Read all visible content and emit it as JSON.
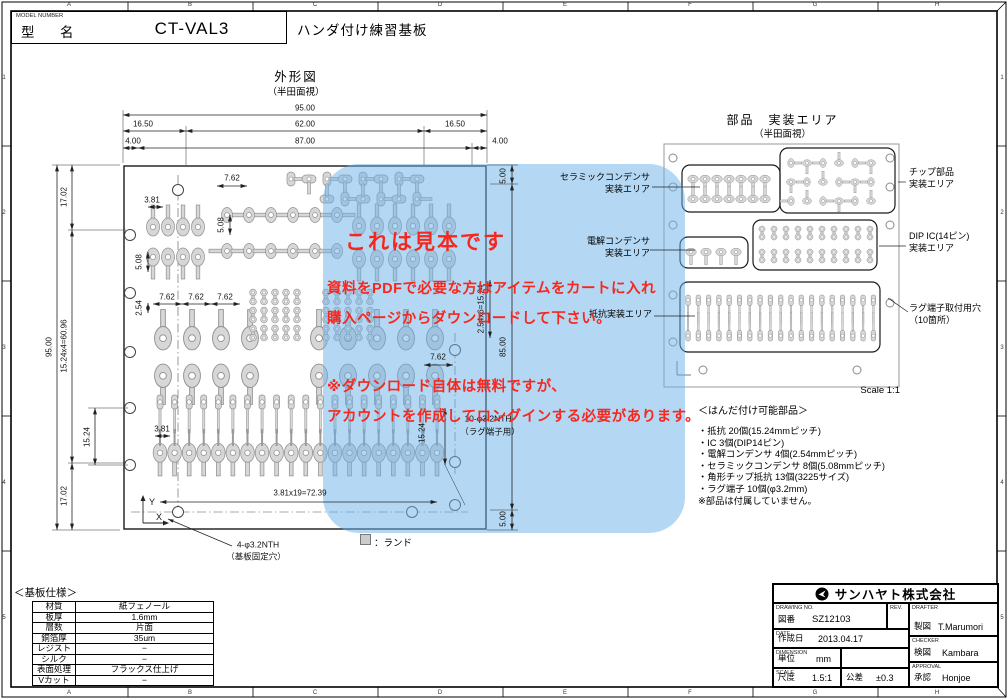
{
  "frame": {
    "cols": [
      "A",
      "B",
      "C",
      "D",
      "E",
      "F",
      "G",
      "H"
    ],
    "rows": [
      "1",
      "2",
      "3",
      "4",
      "5"
    ]
  },
  "title_top": {
    "model_number_label": "MODEL NUMBER",
    "model_label": "型　名",
    "model_value": "CT-VAL3",
    "product_name": "ハンダ付け練習基板"
  },
  "outline": {
    "title": "外形図",
    "subtitle": "（半田面視）"
  },
  "mount_view": {
    "title": "部品　実装エリア",
    "subtitle": "（半田面視）",
    "chip_1": "チップ部品",
    "chip_2": "実装エリア",
    "dip_1": "DIP IC(14ピン)",
    "dip_2": "実装エリア",
    "lug_1": "ラグ端子取付用穴",
    "lug_2": "（10箇所）",
    "scale_note": "Scale 1:1"
  },
  "area_labels": {
    "ceramic_1": "セラミックコンデンサ",
    "ceramic_2": "実装エリア",
    "elec_1": "電解コンデンサ",
    "elec_2": "実装エリア",
    "res": "抵抗実装エリア"
  },
  "dims": {
    "w95": "95.00",
    "w165a": "16.50",
    "w62": "62.00",
    "w165b": "16.50",
    "w4a": "4.00",
    "w87": "87.00",
    "w4b": "4.00",
    "h95": "95.00",
    "h1702a": "17.02",
    "h1524x4": "15.24x4=60.96",
    "h1702b": "17.02",
    "h1524": "15.24",
    "p762a": "7.62",
    "p381a": "3.81",
    "p508a": "5.08",
    "p508b": "5.08",
    "p254": "2.54",
    "p762b": "7.62",
    "p762c": "7.62",
    "p762d": "7.62",
    "p381b": "3.81",
    "p762e": "7.62",
    "row381": "3.81x19=72.39",
    "v254x6": "2.54x6=15.24",
    "v85": "85.00",
    "v1524": "15.24",
    "v5a": "5.00",
    "v5b": "5.00"
  },
  "notes": {
    "hole1a": "4-φ3.2NTH",
    "hole1b": "（基板固定穴）",
    "hole2a": "10-φ3.2NTH",
    "hole2b": "（ラグ端子用）",
    "land": "：ランド",
    "axis_x": "X",
    "axis_y": "Y"
  },
  "watermark": {
    "headline": "これは見本です",
    "lines": [
      "資料をPDFで必要な方はアイテムをカートに入れ",
      "購入ページからダウンロードして下さい。",
      "※ダウンロード自体は無料ですが、",
      "アカウントを作成してロングインする必要があります。"
    ]
  },
  "parts": {
    "title": "＜はんだ付け可能部品＞",
    "items": [
      "・抵抗 20個(15.24mmピッチ)",
      "・IC 3個(DIP14ピン)",
      "・電解コンデンサ 4個(2.54mmピッチ)",
      "・セラミックコンデンサ 8個(5.08mmピッチ)",
      "・角形チップ抵抗 13個(3225サイズ)",
      "・ラグ端子 10個(φ3.2mm)"
    ],
    "note": "※部品は付属していません。"
  },
  "board_spec": {
    "title": "＜基板仕様＞",
    "rows": [
      [
        "材質",
        "紙フェノール"
      ],
      [
        "板厚",
        "1.6mm"
      ],
      [
        "層数",
        "片面"
      ],
      [
        "銅箔厚",
        "35um"
      ],
      [
        "レジスト",
        "−"
      ],
      [
        "シルク",
        "−"
      ],
      [
        "表面処理",
        "フラックス仕上げ"
      ],
      [
        "Vカット",
        "−"
      ]
    ]
  },
  "title_block": {
    "company": "サンハヤト株式会社",
    "drawing_no_label": "DRAWING NO.",
    "drawing_no_jp": "図番",
    "drawing_no": "SZ12103",
    "rev_label": "REV.",
    "date_label": "DATE",
    "date_jp": "作成日",
    "date": "2013.04.17",
    "dimension_label": "DIMENSION",
    "unit_jp": "単位",
    "unit": "mm",
    "scale_label": "SCALE",
    "scale_jp": "尺度",
    "scale": "1.5:1",
    "tolerance_jp": "公差",
    "tolerance": "±0.3",
    "drafter_label": "DRAFTER",
    "drafter_jp": "製図",
    "drafter": "T.Marumori",
    "checker_label": "CHECKER",
    "checker_jp": "検図",
    "checker": "Kambara",
    "approval_label": "APPROVAL",
    "approval_jp": "承認",
    "approval": "Honjoe"
  },
  "colors": {
    "overlay": "#69b2e8",
    "watermark_red": "#f6281e",
    "pad_fill": "#d7d7d7",
    "pad_stroke": "#8f8f8f"
  }
}
